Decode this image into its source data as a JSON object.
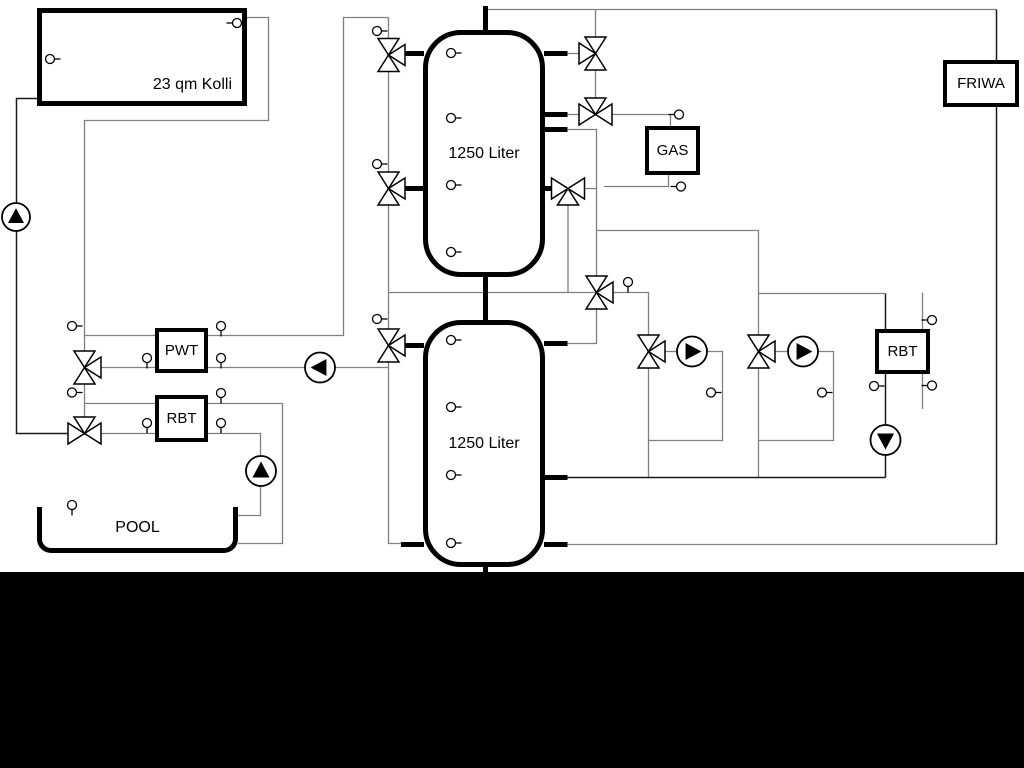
{
  "labels": {
    "collector": "23 qm Kolli",
    "tank_top": "1250 Liter",
    "tank_bottom": "1250 Liter",
    "gas": "GAS",
    "friwa": "FRIWA",
    "pwt": "PWT",
    "rbt_left": "RBT",
    "rbt_right": "RBT",
    "pool": "POOL"
  },
  "colors": {
    "background": "#ffffff",
    "pipe_gray": "#808080",
    "pipe_dark": "#1a1a1a",
    "component_stroke": "#000000",
    "letterbox": "#000000"
  },
  "schematic": {
    "pipes_gray": [
      "M247,17.5 H268.5 V120.5 H84.5 V418",
      "M84.5,335.5 H155",
      "M84.5,367.5 H155",
      "M208,367.5 H388.5",
      "M84.5,403.5 H155",
      "M84.5,433.5 H155",
      "M208,403.5 H282.5 V543.5 H238",
      "M208,433.5 H260.5 V515.5 H238",
      "M208,335.5 H343.5 V17.5 H388.5",
      "M388.5,17.5 V543.5 H424",
      "M388.5,292.5 H648.5 V477.5",
      "M567,129.5 H596.5 V343.5 H567",
      "M596.5,230.5 H758.5 V477.5",
      "M664,351.5 H678",
      "M706,351.5 H722.5 V440.5 H648.5",
      "M775,351.5 H789",
      "M817,351.5 H833.5 V440.5 H758.5",
      "M758.5,293.5 H885.5",
      "M595.5,9.5 V37 M595.5,69.5 V98.5",
      "M567,53.5 H579 M567,114.5 H579",
      "M612,114.5 H670.5 V126",
      "M668.5,175 V186.5 H604",
      "M584,188.5 H596.5",
      "M568,204.5 V292.5",
      "M545,188.5 H551.5",
      "M922.5,292.5 V329 M922.5,374 V409",
      "M567,544.5 H996.5",
      "M485,9.5 H996.5"
    ],
    "pipes_dark": [
      "M37,98.5 H16.5 V433.5 H67.5",
      "M996.5,9.5 V544.5",
      "M567,477.5 H885.5",
      "M885.5,293.5 V477.5"
    ],
    "stubs": [
      "M485.5,6 V31",
      "M485.5,276 V321",
      "M485.5,566 V572",
      "M403,53.5 H424",
      "M403,188.5 H424",
      "M544,53.5 H567.5",
      "M544,114.5 H567.5",
      "M544,129.5 H567.5",
      "M544,188.5 H552.5",
      "M403,345.5 H424",
      "M401,544.5 H424",
      "M544,343.5 H567.5",
      "M544,477.5 H567.5",
      "M544,544.5 H567.5"
    ],
    "valves": [
      {
        "x": 595.5,
        "y": 53.5,
        "t": "vb",
        "a": "left"
      },
      {
        "x": 595.5,
        "y": 114.5,
        "t": "hb",
        "a": "top"
      },
      {
        "x": 568,
        "y": 188.5,
        "t": "hb",
        "a": "bottom"
      },
      {
        "x": 596.5,
        "y": 292.5,
        "t": "vb",
        "a": "right"
      },
      {
        "x": 388.5,
        "y": 55,
        "t": "vb",
        "a": "right"
      },
      {
        "x": 388.5,
        "y": 188.5,
        "t": "vb",
        "a": "right"
      },
      {
        "x": 388.5,
        "y": 345.5,
        "t": "vb",
        "a": "right"
      },
      {
        "x": 84.5,
        "y": 367.5,
        "t": "vb",
        "a": "right"
      },
      {
        "x": 84.5,
        "y": 433.5,
        "t": "hb",
        "a": "top"
      },
      {
        "x": 648.5,
        "y": 351.5,
        "t": "vb",
        "a": "right"
      },
      {
        "x": 758.5,
        "y": 351.5,
        "t": "vb",
        "a": "right"
      }
    ],
    "pumps": [
      {
        "x": 16,
        "y": 217,
        "r": 14,
        "dir": "up"
      },
      {
        "x": 261,
        "y": 471,
        "r": 15,
        "dir": "up"
      },
      {
        "x": 320,
        "y": 367.5,
        "r": 15,
        "dir": "left"
      },
      {
        "x": 692,
        "y": 351.5,
        "r": 15,
        "dir": "right"
      },
      {
        "x": 803,
        "y": 351.5,
        "r": 15,
        "dir": "right"
      },
      {
        "x": 885.5,
        "y": 440,
        "r": 15,
        "dir": "down"
      }
    ],
    "sensors": [
      {
        "x": 50,
        "y": 59,
        "stem": "right"
      },
      {
        "x": 237,
        "y": 23,
        "stem": "left"
      },
      {
        "x": 451,
        "y": 53,
        "stem": "right"
      },
      {
        "x": 451,
        "y": 118,
        "stem": "right"
      },
      {
        "x": 451,
        "y": 185,
        "stem": "right"
      },
      {
        "x": 451,
        "y": 252,
        "stem": "right"
      },
      {
        "x": 451,
        "y": 340,
        "stem": "right"
      },
      {
        "x": 451,
        "y": 407,
        "stem": "right"
      },
      {
        "x": 451,
        "y": 475,
        "stem": "right"
      },
      {
        "x": 451,
        "y": 543,
        "stem": "right"
      },
      {
        "x": 377,
        "y": 31,
        "stem": "right"
      },
      {
        "x": 377,
        "y": 164,
        "stem": "right"
      },
      {
        "x": 377,
        "y": 319,
        "stem": "right"
      },
      {
        "x": 679,
        "y": 114.5,
        "stem": "left"
      },
      {
        "x": 681,
        "y": 186.5,
        "stem": "left"
      },
      {
        "x": 628,
        "y": 282,
        "stem": "down"
      },
      {
        "x": 711,
        "y": 392.5,
        "stem": "right"
      },
      {
        "x": 822,
        "y": 392.5,
        "stem": "right"
      },
      {
        "x": 932,
        "y": 320,
        "stem": "left"
      },
      {
        "x": 932,
        "y": 385.5,
        "stem": "left"
      },
      {
        "x": 874,
        "y": 386,
        "stem": "right"
      },
      {
        "x": 72,
        "y": 326,
        "stem": "right"
      },
      {
        "x": 147,
        "y": 358,
        "stem": "down"
      },
      {
        "x": 221,
        "y": 358,
        "stem": "down"
      },
      {
        "x": 221,
        "y": 326,
        "stem": "down"
      },
      {
        "x": 72,
        "y": 392.5,
        "stem": "right"
      },
      {
        "x": 147,
        "y": 423,
        "stem": "down"
      },
      {
        "x": 221,
        "y": 423,
        "stem": "down"
      },
      {
        "x": 221,
        "y": 393,
        "stem": "down"
      },
      {
        "x": 72,
        "y": 505,
        "stem": "down"
      }
    ]
  }
}
